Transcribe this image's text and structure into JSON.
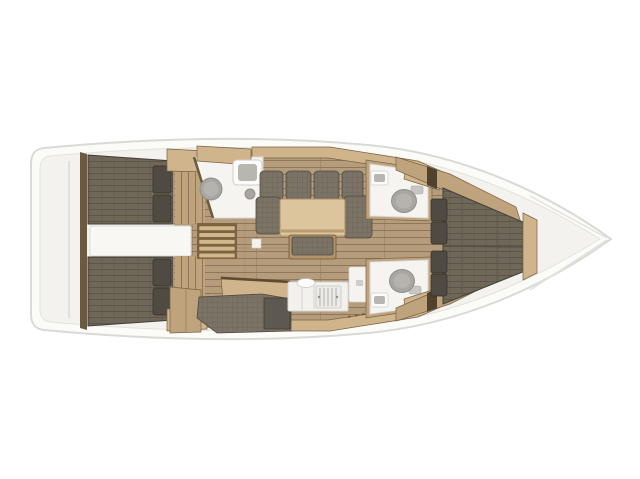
{
  "meta": {
    "title": "Sailboat interior layout plan, top-down view, bow to the right",
    "canvas": {
      "width": 640,
      "height": 479
    }
  },
  "palette": {
    "background": "#ffffff",
    "hull_fill": "#fbfbf8",
    "hull_stroke": "#d9d9d5",
    "deck_fill": "#f3f2ee",
    "deck_stroke": "#e3e2de",
    "wood_floor": "#b59c7c",
    "wood_seam": "#8f7656",
    "wood_mid": "#bfa37c",
    "wood_light": "#cfb48c",
    "wood_dark": "#6b5940",
    "outline": "#7a6345",
    "fabric": "#7b7466",
    "fabric_weave": "#6b6557",
    "pillow": "#4f4b42",
    "bed": "#6f6859",
    "bed_seam": "#5c564a",
    "fixture": "#f5f4f0",
    "fixture_stroke": "#d9d8d4",
    "metal": "#a7a6a1",
    "table": "#dcc49c"
  },
  "vessel": {
    "orientation": "bow-right",
    "rooms": [
      {
        "name": "aft-cabin-port",
        "features": [
          "double-berth",
          "two-pillows",
          "wood-floor",
          "cabinet"
        ]
      },
      {
        "name": "aft-cabin-starboard",
        "features": [
          "double-berth",
          "two-pillows",
          "wood-floor",
          "cabinet"
        ]
      },
      {
        "name": "engine-compartment",
        "features": [
          "white-box-between-aft-cabins"
        ]
      },
      {
        "name": "companionway",
        "features": [
          "wooden-ladder-five-rungs"
        ]
      },
      {
        "name": "aft-wet-room",
        "features": [
          "round-shower-sink",
          "square-basin",
          "knob",
          "wood-cabinet"
        ]
      },
      {
        "name": "salon",
        "features": [
          "u-shaped-sofa",
          "wood-table",
          "bench-seat",
          "floor-hatch"
        ]
      },
      {
        "name": "galley",
        "features": [
          "wood-desk",
          "white-counter",
          "stove",
          "sink",
          "fridge",
          "upholstered-bench",
          "dark-hatch"
        ]
      },
      {
        "name": "head-port",
        "features": [
          "toilet",
          "basin",
          "wood-cabinet"
        ]
      },
      {
        "name": "head-starboard",
        "features": [
          "toilet",
          "basin",
          "wood-cabinet"
        ]
      },
      {
        "name": "forward-cabin",
        "features": [
          "v-berth",
          "four-pillows",
          "wood-side-shelves",
          "foot-trim"
        ]
      },
      {
        "name": "bow-locker",
        "features": [
          "white-anchor-locker"
        ]
      }
    ]
  }
}
